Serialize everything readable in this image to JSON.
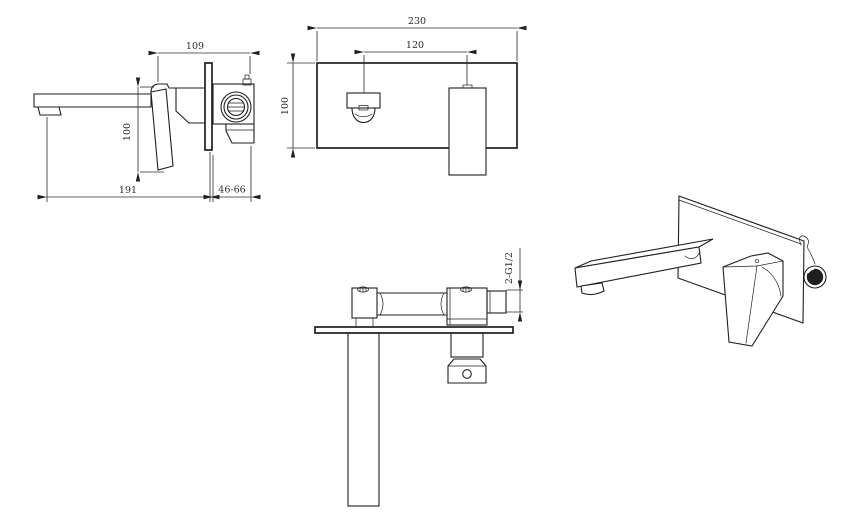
{
  "drawing": {
    "background": "#ffffff",
    "line_color": "#1f1f1f",
    "views": {
      "side": {
        "width_top": "109",
        "height": "100",
        "reach": "191",
        "wall_depth_range": "46-66"
      },
      "front": {
        "plate_width": "230",
        "center_distance": "120",
        "plate_height": "100"
      },
      "top": {
        "thread_spec": "2-G1/2"
      }
    }
  }
}
